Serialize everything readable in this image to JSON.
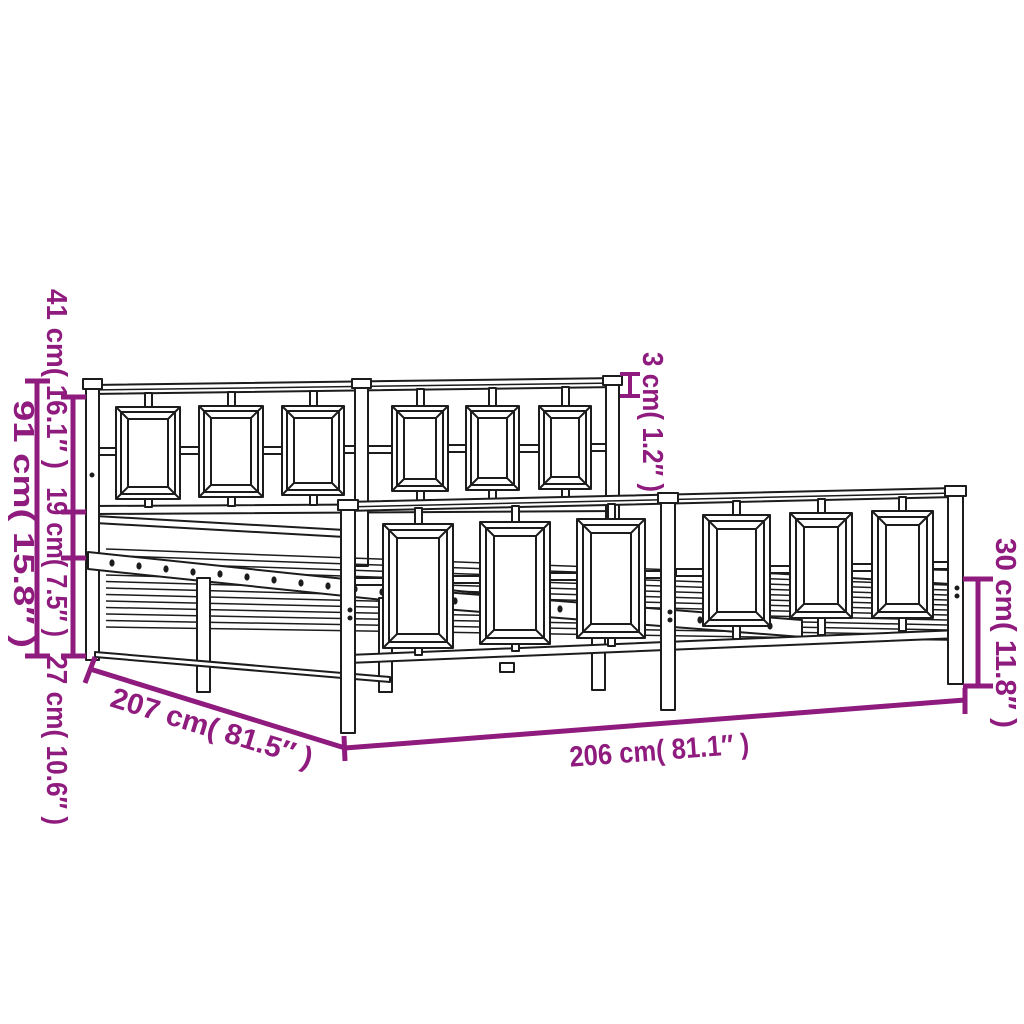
{
  "accent_color": "#8e1b7d",
  "line_color": "#1c1c1c",
  "background_color": "#ffffff",
  "diagram": {
    "type": "product-dimension-diagram",
    "subject": "metal bed frame with headboard and footboard",
    "dimensions": {
      "headboard_upper_height": "41 cm( 16.1″ )",
      "frame_mid_height": "19 cm( 7.5″ )",
      "base_clearance_height": "27 cm( 10.6″ )",
      "headboard_total_height": "91 cm( 15.8″ )",
      "tube_thickness": "3 cm( 1.2″ )",
      "footboard_height": "30 cm( 11.8″ )",
      "total_length": "207 cm( 81.5″ )",
      "inner_length": "206 cm( 81.1″ )"
    }
  }
}
